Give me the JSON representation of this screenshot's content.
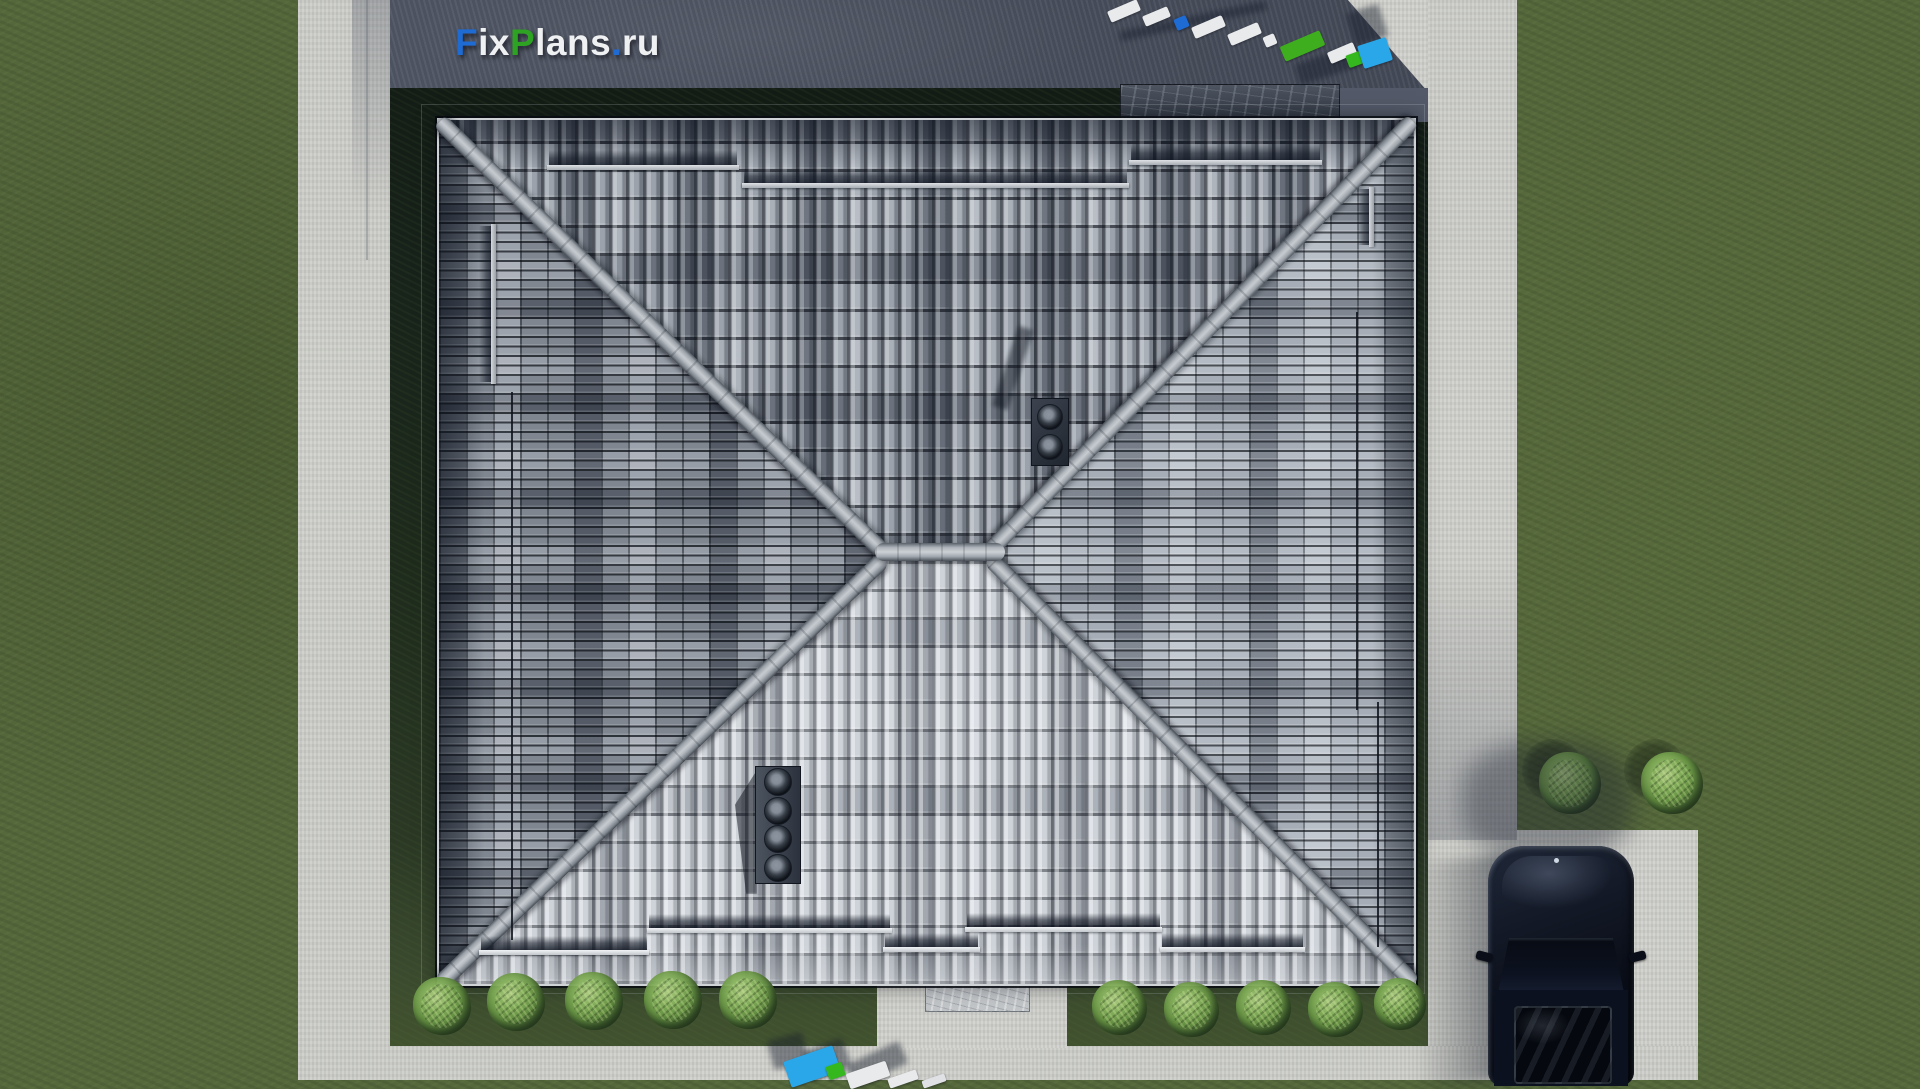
{
  "watermark": {
    "site_text": "FixPlans.ru",
    "segments": [
      {
        "text": "F",
        "color": "#1f6bd4"
      },
      {
        "text": "ix",
        "color": "#eff0f2"
      },
      {
        "text": "P",
        "color": "#2ea223"
      },
      {
        "text": "lans",
        "color": "#eff0f2"
      },
      {
        "text": ".",
        "color": "#1f6bd4"
      },
      {
        "text": "ru",
        "color": "#eff0f2"
      }
    ]
  },
  "palette": {
    "grass": "#55683c",
    "plot_lawn_dark": "#17221a",
    "concrete_light": "#cdcec9",
    "concrete_shadow": "#575d6c",
    "roof_ridge": "#c6cbd0",
    "roof_north_base": "#9ba2ab",
    "roof_south_base": "#ced3d9",
    "roof_west_base": "#7f8690",
    "roof_east_base": "#a6adb6",
    "car_body": "#0d1220",
    "brand_blue": "#1f6bd4",
    "brand_green": "#2ea223",
    "brand_cyan": "#2aa7e8"
  },
  "scene": {
    "roof_fixtures": [
      {
        "name": "snow-guard-rail",
        "cls": "rail-h",
        "x": 108,
        "y": 45,
        "w": 192,
        "h": 5
      },
      {
        "name": "snow-guard-rail",
        "cls": "rail-h",
        "x": 303,
        "y": 63,
        "w": 387,
        "h": 5
      },
      {
        "name": "snow-guard-rail",
        "cls": "rail-h",
        "x": 690,
        "y": 40,
        "w": 193,
        "h": 5
      },
      {
        "name": "snow-guard-rail",
        "cls": "rail-s",
        "x": 40,
        "y": 830,
        "w": 170,
        "h": 5
      },
      {
        "name": "snow-guard-rail",
        "cls": "rail-s",
        "x": 208,
        "y": 808,
        "w": 245,
        "h": 5
      },
      {
        "name": "snow-guard-rail",
        "cls": "rail-s",
        "x": 444,
        "y": 827,
        "w": 97,
        "h": 5
      },
      {
        "name": "snow-guard-rail",
        "cls": "rail-s",
        "x": 526,
        "y": 807,
        "w": 197,
        "h": 5
      },
      {
        "name": "snow-guard-rail",
        "cls": "rail-s",
        "x": 721,
        "y": 827,
        "w": 145,
        "h": 5
      },
      {
        "name": "snow-guard-rail",
        "cls": "rail-v",
        "x": 52,
        "y": 104,
        "w": 5,
        "h": 160
      },
      {
        "name": "snow-guard-rail",
        "cls": "rail-v",
        "x": 930,
        "y": 67,
        "w": 5,
        "h": 60
      },
      {
        "name": "roof-wire",
        "cls": "wire",
        "x": 72,
        "y": 272,
        "w": 2,
        "h": 548
      },
      {
        "name": "roof-wire",
        "cls": "wire",
        "x": 917,
        "y": 192,
        "w": 2,
        "h": 398
      },
      {
        "name": "roof-wire",
        "cls": "wire",
        "x": 938,
        "y": 582,
        "w": 2,
        "h": 245
      }
    ],
    "bushes": [
      {
        "name": "bush",
        "cls": "bush",
        "x": 413,
        "y": 977,
        "w": 58,
        "h": 58
      },
      {
        "name": "bush",
        "cls": "bush",
        "x": 487,
        "y": 973,
        "w": 58,
        "h": 58
      },
      {
        "name": "bush",
        "cls": "bush",
        "x": 565,
        "y": 972,
        "w": 58,
        "h": 58
      },
      {
        "name": "bush",
        "cls": "bush",
        "x": 644,
        "y": 971,
        "w": 58,
        "h": 58
      },
      {
        "name": "bush",
        "cls": "bush",
        "x": 719,
        "y": 971,
        "w": 58,
        "h": 58
      },
      {
        "name": "bush",
        "cls": "bush",
        "x": 1092,
        "y": 980,
        "w": 55,
        "h": 55
      },
      {
        "name": "bush",
        "cls": "bush",
        "x": 1164,
        "y": 982,
        "w": 55,
        "h": 55
      },
      {
        "name": "bush",
        "cls": "bush",
        "x": 1236,
        "y": 980,
        "w": 55,
        "h": 55
      },
      {
        "name": "bush",
        "cls": "bush",
        "x": 1308,
        "y": 982,
        "w": 55,
        "h": 55
      },
      {
        "name": "bush",
        "cls": "bush",
        "x": 1374,
        "y": 978,
        "w": 52,
        "h": 52
      },
      {
        "name": "bush",
        "cls": "bush",
        "x": 1539,
        "y": 752,
        "w": 62,
        "h": 62
      },
      {
        "name": "bush",
        "cls": "bush",
        "x": 1641,
        "y": 752,
        "w": 62,
        "h": 62
      }
    ],
    "watermark_blocks_top": [
      {
        "name": "shadow",
        "cls": "blk-shadow",
        "x": 1118,
        "y": 16,
        "w": 150,
        "h": 10,
        "rot": -12
      },
      {
        "name": "shadow",
        "cls": "blk-shadow",
        "x": 1350,
        "y": 8,
        "w": 34,
        "h": 34,
        "rot": -18
      },
      {
        "name": "shadow",
        "cls": "blk-shadow",
        "x": 1296,
        "y": 54,
        "w": 64,
        "h": 22,
        "rot": -18
      },
      {
        "name": "watermark-3d-block",
        "cls": "blk",
        "x": 1108,
        "y": 5,
        "w": 32,
        "h": 12,
        "rot": -23,
        "bg": "#e9eaec"
      },
      {
        "name": "watermark-3d-block",
        "cls": "blk",
        "x": 1143,
        "y": 11,
        "w": 27,
        "h": 11,
        "rot": -23,
        "bg": "#e9eaec"
      },
      {
        "name": "watermark-3d-block",
        "cls": "blk",
        "x": 1175,
        "y": 17,
        "w": 13,
        "h": 12,
        "rot": -23,
        "bg": "#1f6bd4"
      },
      {
        "name": "watermark-3d-block",
        "cls": "blk",
        "x": 1192,
        "y": 21,
        "w": 33,
        "h": 12,
        "rot": -23,
        "bg": "#e9eaec"
      },
      {
        "name": "watermark-3d-block",
        "cls": "blk",
        "x": 1228,
        "y": 28,
        "w": 33,
        "h": 12,
        "rot": -23,
        "bg": "#e9eaec"
      },
      {
        "name": "watermark-3d-block",
        "cls": "blk",
        "x": 1264,
        "y": 35,
        "w": 12,
        "h": 11,
        "rot": -23,
        "bg": "#e9eaec"
      },
      {
        "name": "watermark-3d-block",
        "cls": "blk",
        "x": 1281,
        "y": 38,
        "w": 43,
        "h": 16,
        "rot": -23,
        "bg": "#3fae1e"
      },
      {
        "name": "watermark-3d-block",
        "cls": "blk",
        "x": 1328,
        "y": 47,
        "w": 28,
        "h": 12,
        "rot": -23,
        "bg": "#e9eaec"
      },
      {
        "name": "watermark-3d-block",
        "cls": "blk",
        "x": 1347,
        "y": 53,
        "w": 15,
        "h": 13,
        "rot": -20,
        "bg": "#35b81e"
      },
      {
        "name": "watermark-3d-block",
        "cls": "blk",
        "x": 1360,
        "y": 41,
        "w": 30,
        "h": 24,
        "rot": -18,
        "bg": "#2aa7e8"
      }
    ],
    "watermark_blocks_bottom": [
      {
        "name": "shadow",
        "cls": "blk-shadow",
        "x": 770,
        "y": 1036,
        "w": 36,
        "h": 30,
        "rot": -15
      },
      {
        "name": "shadow",
        "cls": "blk-shadow",
        "x": 806,
        "y": 1044,
        "w": 42,
        "h": 30,
        "rot": -20
      },
      {
        "name": "shadow",
        "cls": "blk-shadow",
        "x": 848,
        "y": 1052,
        "w": 58,
        "h": 24,
        "rot": -25
      },
      {
        "name": "watermark-3d-block",
        "cls": "blk",
        "x": 786,
        "y": 1053,
        "w": 52,
        "h": 27,
        "rot": -19,
        "bg": "#2aa7e8"
      },
      {
        "name": "watermark-3d-block",
        "cls": "blk",
        "x": 827,
        "y": 1064,
        "w": 17,
        "h": 14,
        "rot": -19,
        "bg": "#35b81e"
      },
      {
        "name": "watermark-3d-block",
        "cls": "blk",
        "x": 847,
        "y": 1067,
        "w": 42,
        "h": 16,
        "rot": -19,
        "bg": "#e9eaec"
      },
      {
        "name": "watermark-3d-block",
        "cls": "blk",
        "x": 888,
        "y": 1074,
        "w": 30,
        "h": 10,
        "rot": -19,
        "bg": "#e9eaec"
      },
      {
        "name": "watermark-3d-block",
        "cls": "blk",
        "x": 922,
        "y": 1077,
        "w": 24,
        "h": 8,
        "rot": -19,
        "bg": "#dfe1e4"
      }
    ]
  }
}
